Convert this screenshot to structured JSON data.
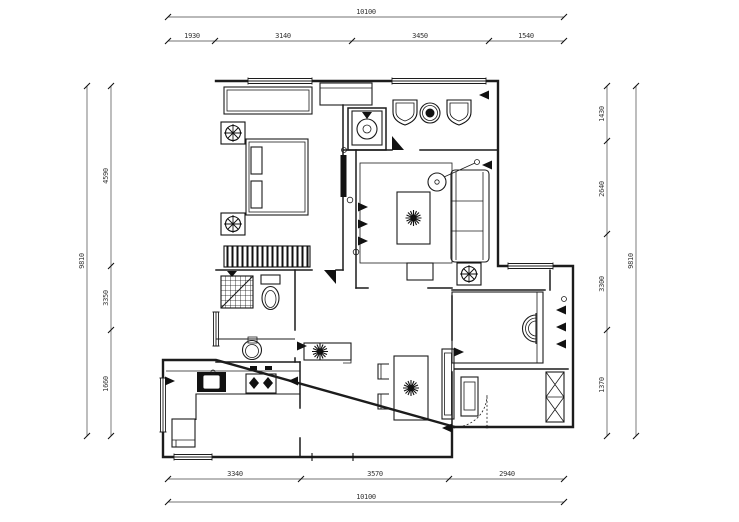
{
  "drawing": {
    "type": "apartment-floor-plan",
    "dims": {
      "top_total": "10100",
      "top_segments": [
        "1930",
        "3140",
        "3450",
        "1540"
      ],
      "bottom_segments": [
        "3340",
        "3570",
        "2940"
      ],
      "bottom_total": "10100",
      "left_total": "9810",
      "left_segments": [
        "4590",
        "3350",
        "1660"
      ],
      "right_segments": [
        "1430",
        "2640",
        "3300",
        "1370"
      ],
      "right_total": "9810"
    }
  },
  "colors": {
    "ink": "#1c1c1c",
    "background": "#ffffff"
  }
}
